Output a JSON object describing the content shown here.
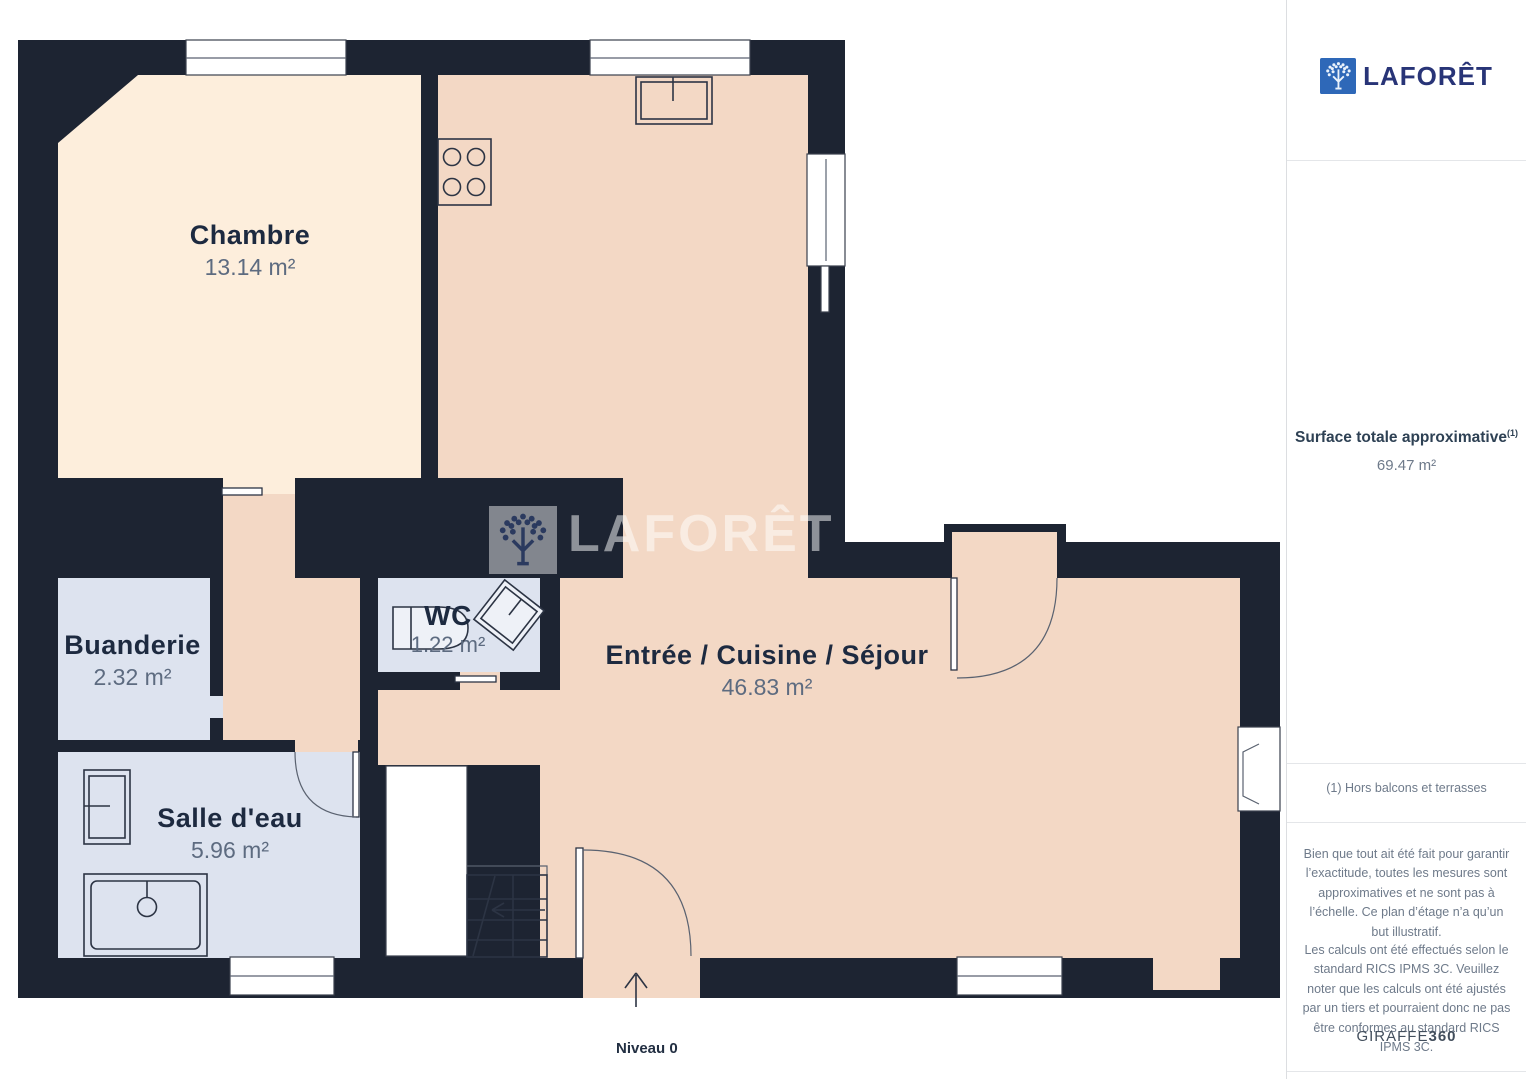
{
  "plan": {
    "level_label": "Niveau 0",
    "watermark": "LAFORÊT"
  },
  "rooms": {
    "chambre": {
      "name": "Chambre",
      "area": "13.14 m²"
    },
    "wc": {
      "name": "WC",
      "area": "1.22 m²"
    },
    "sejour": {
      "name": "Entrée / Cuisine / Séjour",
      "area": "46.83 m²"
    },
    "buanderie": {
      "name": "Buanderie",
      "area": "2.32 m²"
    },
    "salle_eau": {
      "name": "Salle d'eau",
      "area": "5.96 m²"
    }
  },
  "sidebar": {
    "brand": "LAFORÊT",
    "surface_title": "Surface totale approximative",
    "surface_marker": "(1)",
    "surface_value": "69.47 m²",
    "footnote": "(1) Hors balcons et terrasses",
    "disclaimer_1": "Bien que tout ait été fait pour garantir l’exactitude, toutes les mesures sont approximatives et ne sont pas à l’échelle. Ce plan d’étage n’a qu’un but illustratif.",
    "disclaimer_2": "Les calculs ont été effectués selon le standard RICS IPMS 3C. Veuillez noter que les calculs ont été ajustés par un tiers et pourraient donc ne pas être conformes au standard RICS IPMS 3C.",
    "credit_brand": "GIRAFFE",
    "credit_suffix": "360"
  },
  "colors": {
    "wall": "#1d2432",
    "room-warm": "#fdeedc",
    "room-living": "#f3d8c5",
    "room-wet": "#dde3ef",
    "ink": "#1d2a40",
    "muted": "#5d6b80",
    "brand-blue": "#2e68b8",
    "brand-ink": "#283477"
  }
}
